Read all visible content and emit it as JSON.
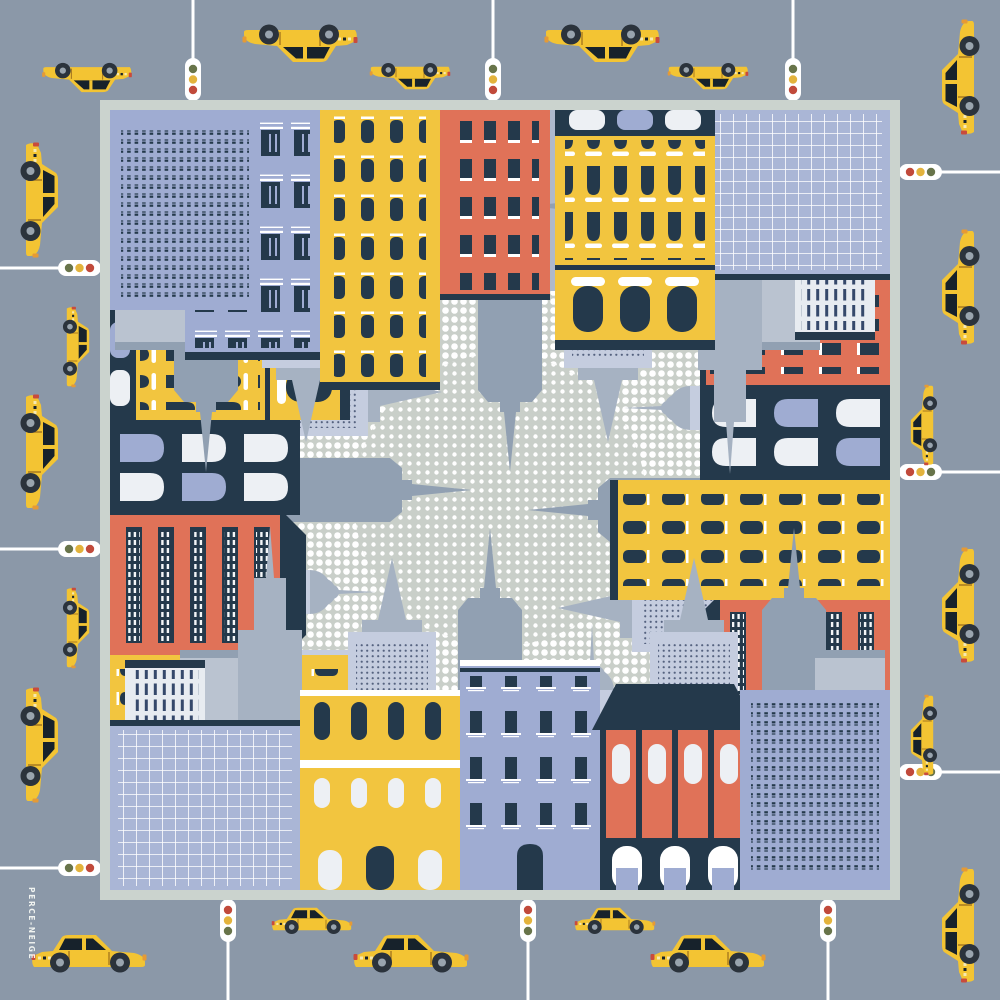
{
  "artwork": {
    "brand": "PERCE-NEIGE",
    "subject": "City-block border illustration with yellow taxis and traffic lights around a halftone dot center"
  },
  "scene": {
    "taxis_count": 21,
    "traffic_lights_count": 12,
    "edges": [
      "top",
      "right",
      "bottom",
      "left"
    ],
    "center_motif": "white halftone dots",
    "border_motif": "colorful city buildings and gray skyscraper spires pointing inward"
  },
  "palette": {
    "bg": "#8B98A8",
    "frame": "#CBD3CE",
    "innerBg": "#AEB9CD",
    "centerBg": "#C9CFC9",
    "dot": "#FFFFFF",
    "yellow": "#F2C53F",
    "orange": "#E07258",
    "navy": "#24394B",
    "peri": "#9FACD2",
    "periL": "#C5CDDF",
    "periG": "#AAB6D6",
    "gray1": "#91A0B2",
    "gray2": "#A6B2C2",
    "gray3": "#BAC3D0",
    "winWhite": "#EDF0F4",
    "taxi": "#F3C433",
    "wheel": "#2B333C",
    "hub": "#99A4AE",
    "tlRed": "#C14A3B",
    "tlYellow": "#E3B33C",
    "tlGreen": "#68744A"
  }
}
